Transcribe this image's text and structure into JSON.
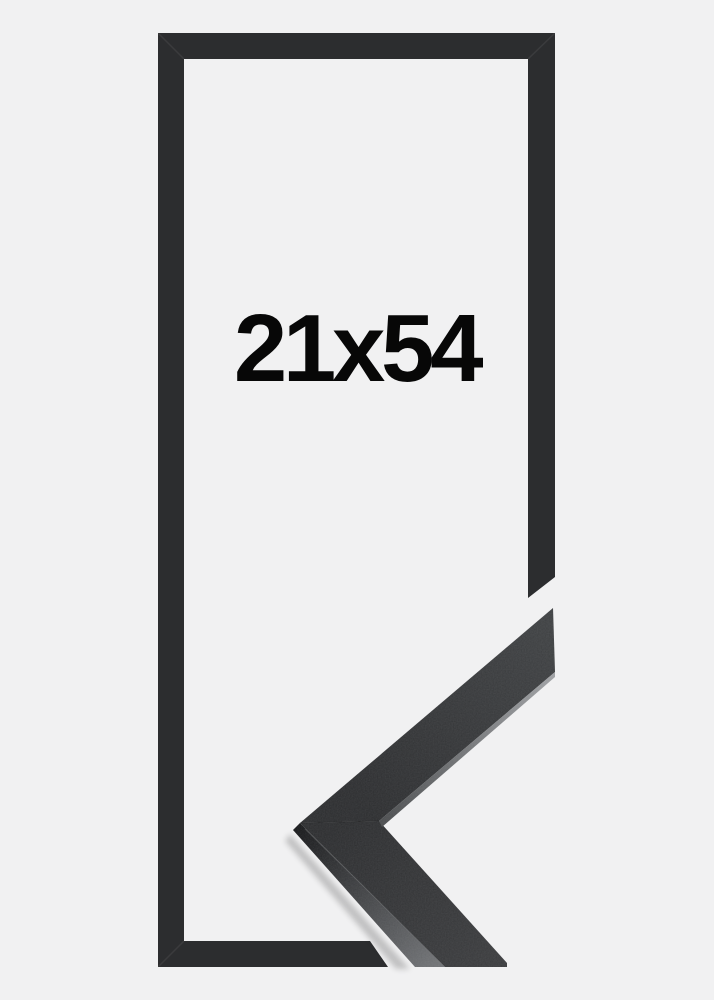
{
  "canvas": {
    "width": 714,
    "height": 1000
  },
  "product": {
    "size_label": "21x54"
  },
  "colors": {
    "background": "#f1f1f2",
    "outline": "#2c2d2f",
    "label": "#070707",
    "moulding_face_dark": "#2c2d2f",
    "moulding_face_light": "#3e4042",
    "moulding_lower_face_light": "#3a3b3d",
    "moulding_side_dark": "#17181a",
    "moulding_side_light": "#707275",
    "edge_highlight_dark": "#4a4c4e",
    "edge_highlight_light": "#a0a2a5"
  }
}
